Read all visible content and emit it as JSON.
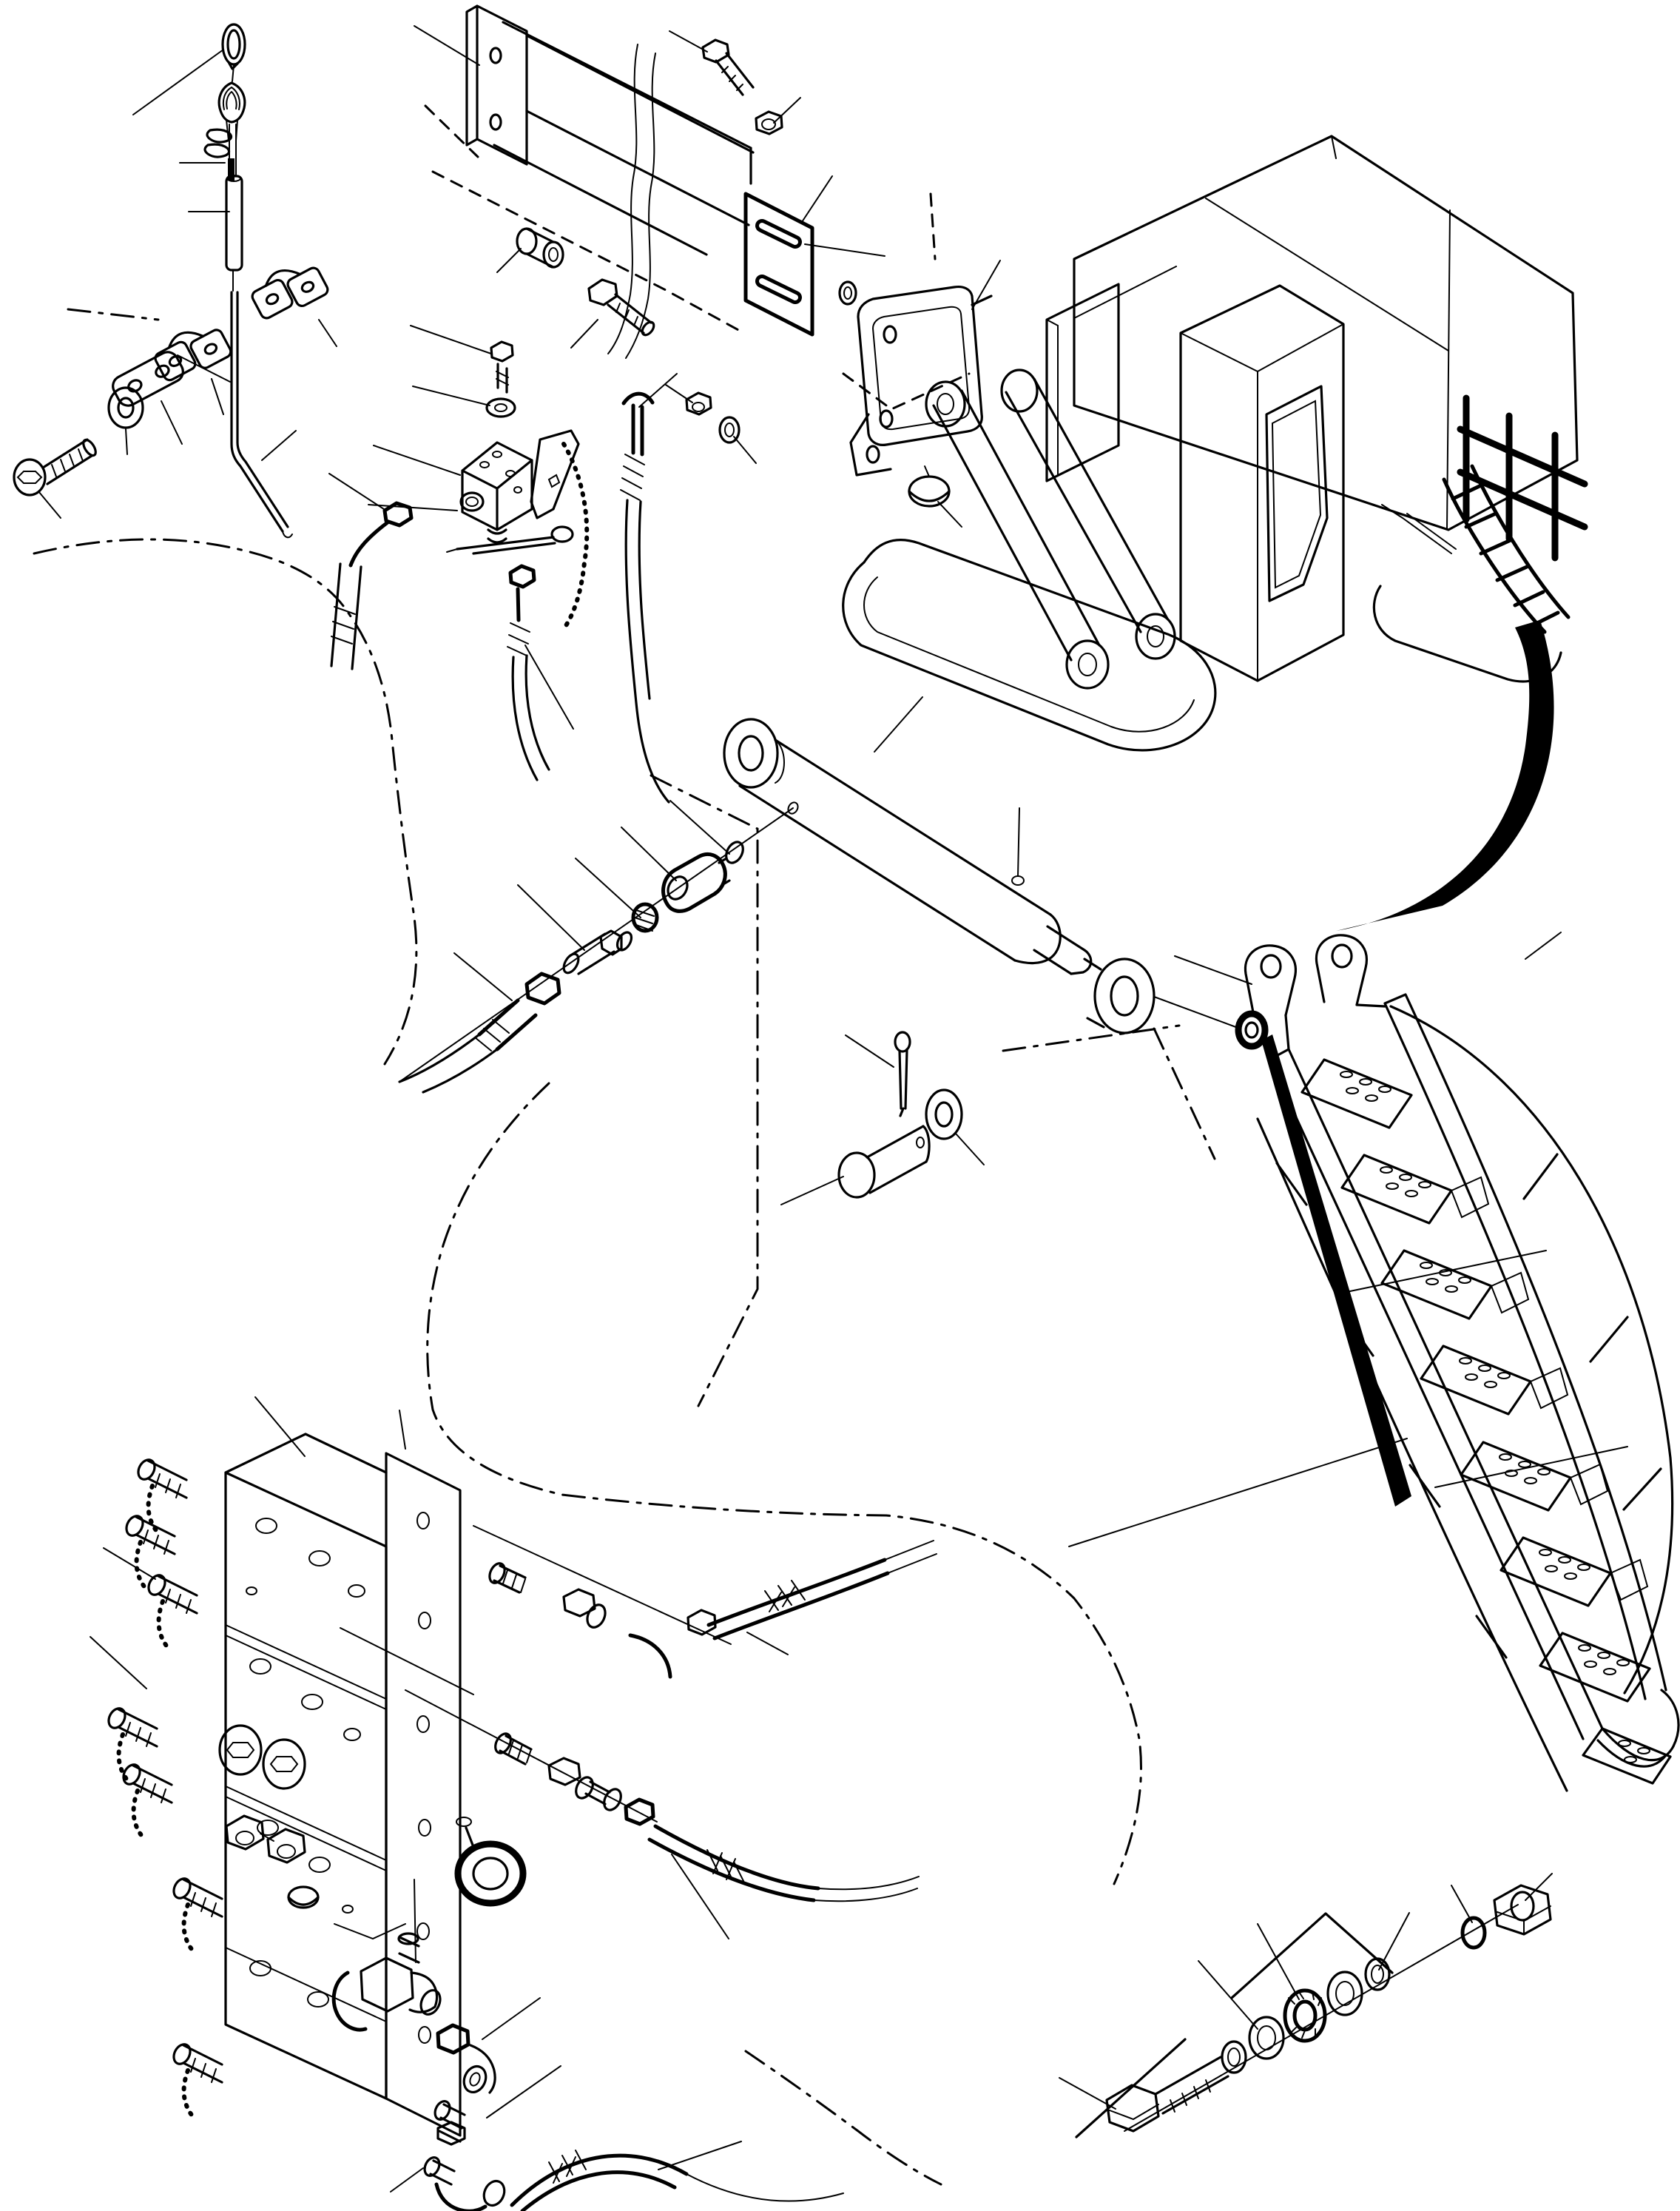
{
  "diagram": {
    "title": "exploded-parts-diagram",
    "subject": "excavator-access-ladder-installation",
    "style": "isometric black line art on white, no text labels",
    "colors": {
      "ink": "#000000",
      "paper": "#ffffff"
    },
    "visible_text": [],
    "annotations": {
      "leader_lines": "plain thin callout lines without numbers",
      "phantom_lines": "dash-dot routing / mounting-plane lines",
      "rotation_arrow": "bold tapered swing arrow from folded ladder to deployed ladder"
    }
  },
  "groups": [
    {
      "id": "pull-cable",
      "label": "release pull-cable assembly",
      "parts": [
        "pull-ring",
        "cable-thimble",
        "wire-clip",
        "wire-clip",
        "control-cable",
        "cable-sleeve",
        "release-rod",
        "clamp-half-upper",
        "clamp-half-lower",
        "clamp-plate",
        "plain-washer",
        "socket-head-cap-screw"
      ]
    },
    {
      "id": "beam-mount",
      "label": "support beam and clamp bracket",
      "parts": [
        "flange-plate",
        "support-beam",
        "hose-loom",
        "spacer-bush",
        "hex-bolt",
        "hex-nut",
        "slotted-wear-plate",
        "lock-nut",
        "flat-washer",
        "seal-washer",
        "clamp-bracket",
        "button-plug",
        "hex-bolt-upper"
      ]
    },
    {
      "id": "machine",
      "label": "excavator overview",
      "parts": [
        "machine-body",
        "operator-cab",
        "cab-window",
        "side-panel",
        "boom-link-arm",
        "boom-link-arm",
        "crawler-track-left",
        "crawler-track-right",
        "deck-handrail",
        "folded-access-ladder",
        "ladder-stay",
        "swing-arrow"
      ]
    },
    {
      "id": "shutoff-valve",
      "label": "shut-off valve block with chained pin",
      "parts": [
        "valve-block",
        "valve-bolt",
        "valve-washer",
        "retainer-bracket",
        "retaining-chain",
        "linch-pin",
        "elbow-hose-fitting",
        "hose-front",
        "hose-rear",
        "hose-drop"
      ]
    },
    {
      "id": "cylinder",
      "label": "hydraulic cylinder with pin set",
      "parts": [
        "cylinder-barrel",
        "cylinder-eye-head",
        "piston-rod",
        "rod-end-eye",
        "grease-nipple",
        "port-plug",
        "o-ring",
        "reducer-bushing",
        "hose-adapter",
        "hose-end-fitting",
        "supply-hose",
        "clevis-pin",
        "pin-washer",
        "cotter-pin"
      ]
    },
    {
      "id": "stairway",
      "label": "deployed access stairway",
      "parts": [
        "mounting-lug",
        "mounting-lug",
        "pivot-eye",
        "side-rail-left",
        "side-rail-right",
        "stair-step",
        "stair-step",
        "stair-step",
        "stair-step",
        "stair-step",
        "stair-step",
        "stair-step",
        "stair-step",
        "handrail-left",
        "handrail-right",
        "brace-bar",
        "foot-handle",
        "rail-edge-wedge"
      ]
    },
    {
      "id": "manifold",
      "label": "control valve manifold",
      "parts": [
        "manifold-block-stack",
        "manifold-side-plate",
        "test-coupling",
        "test-coupling",
        "test-coupling",
        "test-coupling",
        "test-coupling",
        "test-coupling",
        "test-coupling",
        "dust-cap-chain",
        "manifold-washer",
        "manifold-washer",
        "manifold-nut",
        "manifold-nut",
        "protective-cap",
        "lifting-eye"
      ]
    },
    {
      "id": "hose-unions",
      "label": "manifold hose union sets",
      "parts": [
        "straight-nipple",
        "union-adapter",
        "elbow-union",
        "hose-nut",
        "braided-hose-upper",
        "straight-nipple",
        "union-adapter",
        "union-adapter",
        "hose-nut",
        "braided-hose-lower"
      ]
    },
    {
      "id": "tee-set",
      "label": "tee fitting drop assembly",
      "parts": [
        "tee-fitting",
        "union-elbow",
        "adapter-nipple",
        "drop-elbow",
        "feed-hose"
      ]
    },
    {
      "id": "anchor-set",
      "label": "anchor bolt with washer stack",
      "parts": [
        "anchor-bolt",
        "spring-ring",
        "bearing-washer",
        "bearing-ring",
        "bearing-washer",
        "backing-ring",
        "thin-ring",
        "large-lock-nut"
      ]
    }
  ]
}
